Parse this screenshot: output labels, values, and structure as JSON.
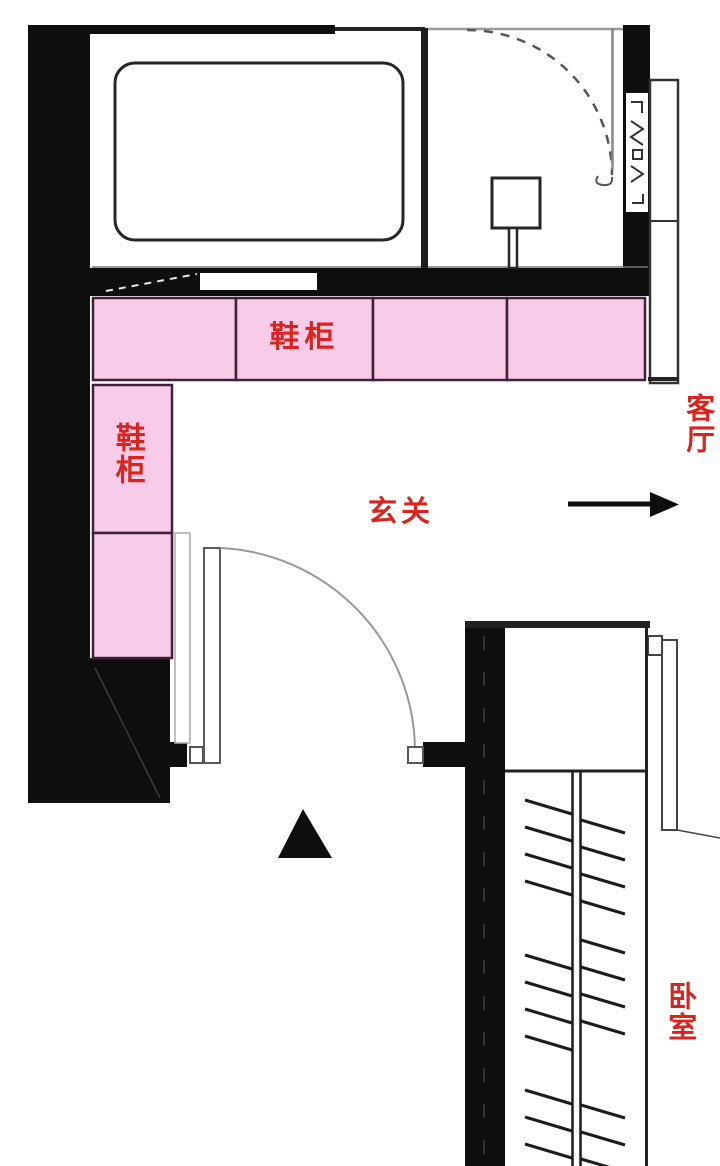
{
  "labels": {
    "shoe_cabinet_top": "鞋柜",
    "shoe_cabinet_left": "鞋柜",
    "entry": "玄关",
    "living_room": "客厅",
    "bedroom": "卧室"
  },
  "colors": {
    "cabinet_pink": "#f8cbe8",
    "cabinet_border": "#3d2238",
    "label_red": "#da251f",
    "wall_black": "#0e0e0e",
    "line_gray": "#888888"
  },
  "icons": {
    "direction_arrow": "right-arrow",
    "entry_marker": "up-triangle"
  },
  "cabinets": {
    "top_row_cells": 4,
    "left_column_cells": 2
  }
}
